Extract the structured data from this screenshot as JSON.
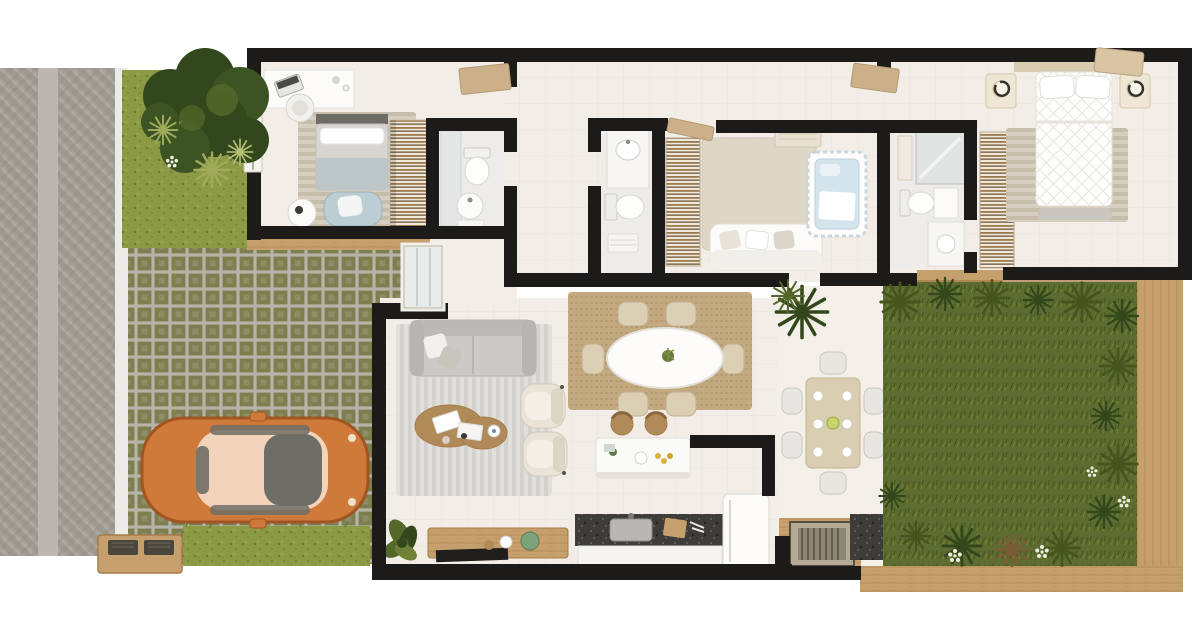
{
  "palette": {
    "paper": "#ffffff",
    "wall": "#1c1b19",
    "street_base": "#a5a39b",
    "street_dark": "#8b897f",
    "street_light": "#b9b7af",
    "curb": "#edebe6",
    "lawn": "#8d9a45",
    "lawn_dark": "#6c7a32",
    "garden": "#5d6d31",
    "garden_dark": "#45551d",
    "foliage_dark": "#32481c",
    "foliage_mid": "#55682b",
    "foliage_light": "#9fab5b",
    "paver_olive": "#7d7f4f",
    "paver_gray": "#b6b4a8",
    "wood_deck": "#c6a06c",
    "wood_deck_dark": "#a67c48",
    "floor": "#f3ede8",
    "floor_bath": "#edecea",
    "rug_gray": "#e0dfdb",
    "rug_stripe": "#d3d2ce",
    "rug_beige": "#ded7c6",
    "jute": "#c3a97f",
    "sofa_gray": "#cccac6",
    "sofa_dark": "#b7b5b1",
    "white_f": "#fcfbf9",
    "cream": "#dbcfb4",
    "wood_f": "#b08a58",
    "granite": "#3d3c38",
    "glass": "#6f6e66",
    "car_body": "#cf7a3a",
    "car_dark": "#a05522",
    "car_roof": "#f3d4ba",
    "blue": "#bccdd4",
    "crib_blue": "#d3e4ec",
    "door_tan": "#ccb089",
    "green_decor": "#7ca27b"
  },
  "scene": {
    "exterior": {
      "street": {
        "texture": "herringbone-pavement",
        "walkway_strip": true
      },
      "front_yard": {
        "tree": 1,
        "ferns": 3,
        "flowers": 1
      },
      "driveway": {
        "texture": "checkered-pavers",
        "lawn_strip": true,
        "utility_box": 1
      },
      "car": {
        "type": "hatchback-top-view",
        "facing": "right"
      },
      "garden": {
        "grass": true,
        "bushes": 15,
        "flower_clusters": 4,
        "wood_border": true
      }
    },
    "rooms": [
      {
        "name": "bedroom-1",
        "furniture": [
          "desk",
          "desk-chair",
          "single-bed",
          "striped-rug",
          "foot-armchair",
          "side-table",
          "wardrobe",
          "window"
        ]
      },
      {
        "name": "bathroom-1",
        "furniture": [
          "shower-glass",
          "toilet",
          "round-sink",
          "towels"
        ]
      },
      {
        "name": "hallway",
        "furniture": []
      },
      {
        "name": "bathroom-2",
        "furniture": [
          "vanity-sink",
          "toilet",
          "towels"
        ]
      },
      {
        "name": "nursery-bedroom",
        "furniture": [
          "closet",
          "rug",
          "sofa",
          "crib",
          "air-conditioner"
        ]
      },
      {
        "name": "bathroom-3",
        "furniture": [
          "mirror-cabinet",
          "shelf",
          "toilet",
          "cabinet",
          "vanity"
        ]
      },
      {
        "name": "master-bedroom",
        "furniture": [
          "closet",
          "headboard",
          "double-bed",
          "pillows",
          "nightstand-left",
          "nightstand-right",
          "lamp-left",
          "lamp-right",
          "striped-rug",
          "foot-bench",
          "ac-unit"
        ]
      },
      {
        "name": "living-room",
        "furniture": [
          "striped-rug",
          "sofa",
          "pillows",
          "coffee-table-duo",
          "armchair-1",
          "armchair-2",
          "tv-console",
          "tv",
          "decor",
          "floor-plant"
        ]
      },
      {
        "name": "dining-area",
        "furniture": [
          "jute-rug",
          "oval-table",
          "chair-x6",
          "centerpiece"
        ]
      },
      {
        "name": "kitchen",
        "furniture": [
          "island",
          "stool-x2",
          "granite-counter",
          "sink",
          "cutting-board",
          "fridge"
        ]
      },
      {
        "name": "gourmet-patio",
        "furniture": [
          "palm-plant",
          "dining-table",
          "chair-x6",
          "tableware",
          "barbecue-grill",
          "granite-counter",
          "wood-deck"
        ]
      }
    ],
    "doors": [
      "front-glass-door",
      "door-leaf-vestibule",
      "door-leaf-corridor",
      "door-leaf-nursery"
    ]
  }
}
